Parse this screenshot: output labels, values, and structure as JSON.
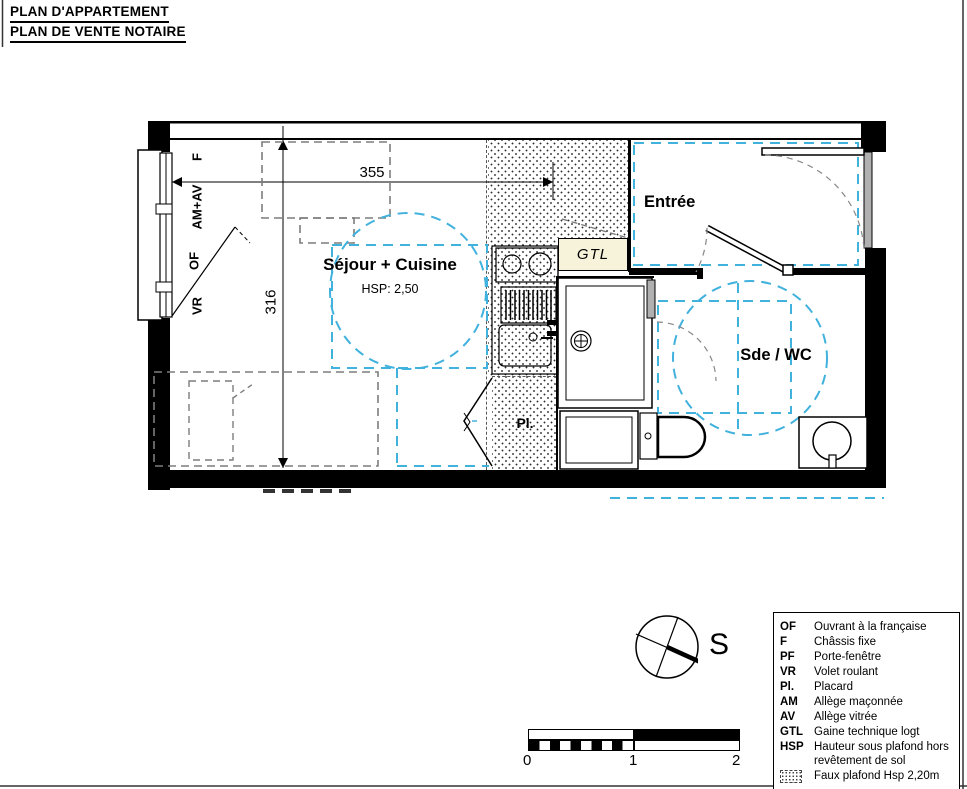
{
  "title": {
    "line1": "PLAN D'APPARTEMENT",
    "line2": "PLAN DE VENTE NOTAIRE"
  },
  "plan": {
    "rooms": {
      "sejour_cuisine": {
        "label": "Séjour + Cuisine",
        "hsp": "HSP: 2,50"
      },
      "entree": {
        "label": "Entrée"
      },
      "sde_wc": {
        "label": "Sde / WC"
      },
      "gtl": {
        "label": "GTL"
      },
      "placard": {
        "label": "Pl."
      }
    },
    "window_labels": {
      "f": "F",
      "am_av": "AM+AV",
      "of": "OF",
      "vr": "VR"
    },
    "dimensions": {
      "width": "355",
      "height": "316"
    }
  },
  "compass": {
    "south": "S"
  },
  "scale_bar": {
    "ticks": [
      "0",
      "1",
      "2"
    ]
  },
  "legend": {
    "items": [
      {
        "key": "OF",
        "label": "Ouvrant à la française"
      },
      {
        "key": "F",
        "label": "Châssis fixe"
      },
      {
        "key": "PF",
        "label": "Porte-fenêtre"
      },
      {
        "key": "VR",
        "label": "Volet roulant"
      },
      {
        "key": "Pl.",
        "label": "Placard"
      },
      {
        "key": "AM",
        "label": "Allège maçonnée"
      },
      {
        "key": "AV",
        "label": "Allège vitrée"
      },
      {
        "key": "GTL",
        "label": "Gaine technique logt"
      },
      {
        "key": "HSP",
        "label": "Hauteur sous plafond hors revêtement de sol"
      },
      {
        "icon": "faux-plafond-hatch-swatch",
        "label": "Faux plafond Hsp 2,20m"
      }
    ]
  },
  "colors": {
    "accessibility_blue": "#41b1dd",
    "furniture_dash_gray": "#7d7d7d",
    "gtl_fill": "#f6f3da"
  }
}
